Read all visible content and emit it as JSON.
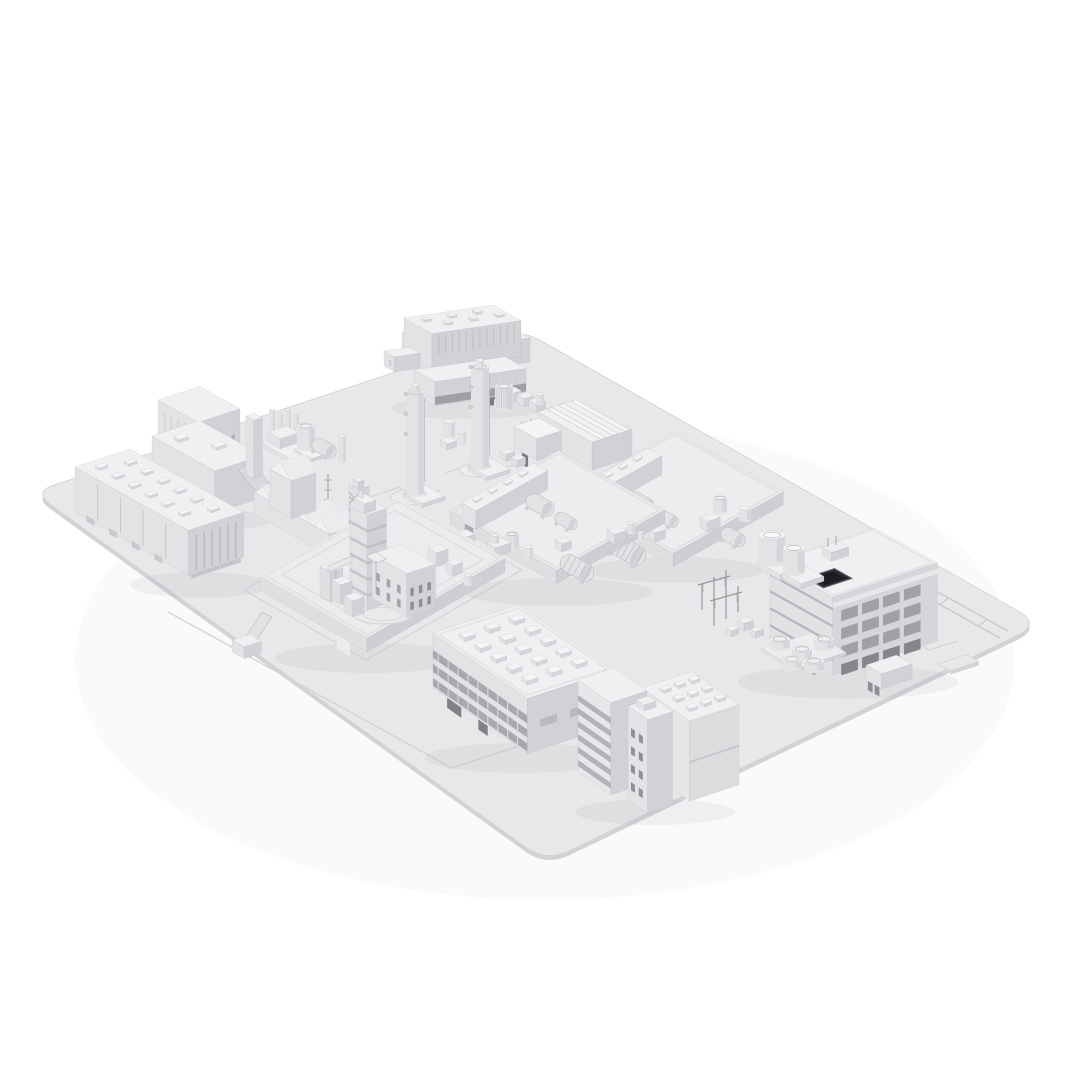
{
  "scene": {
    "type": "3d-architectural-render",
    "subject": "Monochrome isometric 3D model of an industrial plant site arranged on a flat rounded-corner base plate",
    "style": "clay render, all-white/light-gray shading on a white background, no text or UI elements visible",
    "structures": [
      {
        "id": "base-plate",
        "label": "rounded rectangular base plate with engraved road markings and a small edge tab"
      },
      {
        "id": "arched-roof-factory-hall",
        "label": "large factory hall with ribbed arched roof, office annex and elevated walkway"
      },
      {
        "id": "boiler-house",
        "label": "stepped boiler house with discharge chute and slim tower"
      },
      {
        "id": "flat-roof-warehouse",
        "label": "long warehouse with roof hatches and ribbed end wall"
      },
      {
        "id": "process-skids",
        "label": "small process skids with vertical tank, horizontal vessel and columns"
      },
      {
        "id": "gabled-workshop",
        "label": "old workshop with multiple gabled roofs and lattice masts"
      },
      {
        "id": "lattice-derrick",
        "label": "narrow latticed derrick tower"
      },
      {
        "id": "twin-process-columns",
        "label": "two tall cylindrical process columns with nozzles on pads"
      },
      {
        "id": "finned-exchanger",
        "label": "finned vertical heat-exchanger drum and pipe rack"
      },
      {
        "id": "triple-ridge-shed",
        "label": "shed with three roof ridges and white annex"
      },
      {
        "id": "walled-reactor-compound",
        "label": "walled compound with sectioned tower, windowed annex, bridges and circular pad"
      },
      {
        "id": "equipment-yard-left",
        "label": "walled equipment yard with shed, horizontal tanks and drums"
      },
      {
        "id": "equipment-yard-right",
        "label": "walled equipment yard with shed, ribbed tank and vessels"
      },
      {
        "id": "open-frame-plant-building",
        "label": "multi-storey open-frame building with dark roof opening and two round cooling towers"
      },
      {
        "id": "electrical-substation",
        "label": "substation gantry frames with small equipment cabinets"
      },
      {
        "id": "storage-tank-cluster",
        "label": "cluster of five low storage tanks on a pad"
      },
      {
        "id": "utility-shed",
        "label": "small utility shed with open bays"
      },
      {
        "id": "pipe-rack-lines",
        "label": "twin pipe-rack lines running to the plate edge"
      },
      {
        "id": "office-lab-block",
        "label": "long office block with rooftop HVAC units and window bands"
      },
      {
        "id": "louvered-highrise",
        "label": "tall slab with horizontal louver bands, stair tower and roof-vent annex"
      }
    ]
  },
  "palette": {
    "background": "#ffffff",
    "plate_top": "#e8e8ea",
    "plate_side": "#d3d3d6",
    "plate_line": "#d5d5d9",
    "plate_stroke": "#d0d0d4",
    "face_top": "#f0f0f2",
    "face_sw": "#e3e3e6",
    "face_se": "#d2d2d6",
    "face_dark": "#aeaeb3",
    "detail_dark": "#8f8f94",
    "window_dark": "#7b7b80",
    "opening_black": "#2c2c30",
    "line_soft": "#bdbdc2"
  }
}
